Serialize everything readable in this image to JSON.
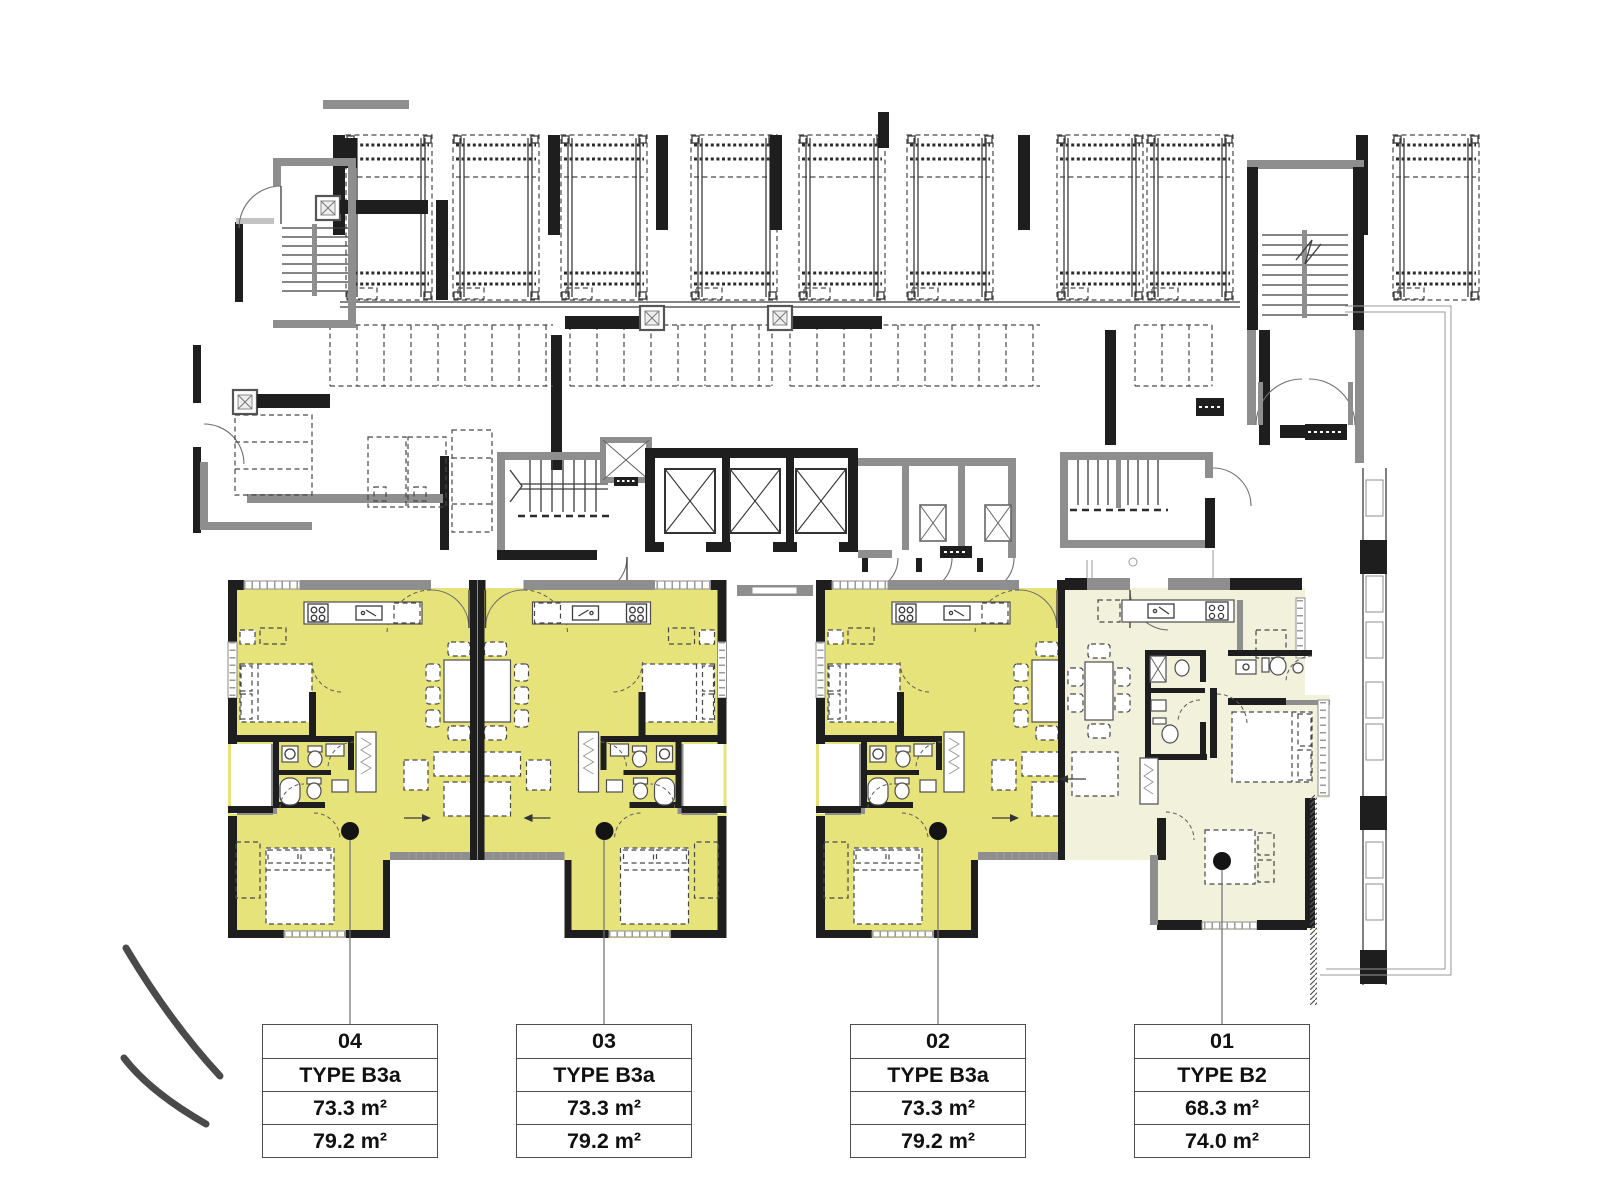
{
  "colors": {
    "unit_highlight": "#e7e37b",
    "unit_muted": "#f2f1dc",
    "wall_dark": "#1e1e1e",
    "wall_gray": "#8e8e8e"
  },
  "units": [
    {
      "number": "04",
      "type": "TYPE B3a",
      "net_area": "73.3 m²",
      "gross_area": "79.2 m²",
      "highlighted": true
    },
    {
      "number": "03",
      "type": "TYPE B3a",
      "net_area": "73.3 m²",
      "gross_area": "79.2 m²",
      "highlighted": true
    },
    {
      "number": "02",
      "type": "TYPE B3a",
      "net_area": "73.3 m²",
      "gross_area": "79.2 m²",
      "highlighted": true
    },
    {
      "number": "01",
      "type": "TYPE B2",
      "net_area": "68.3 m²",
      "gross_area": "74.0 m²",
      "highlighted": false
    }
  ]
}
